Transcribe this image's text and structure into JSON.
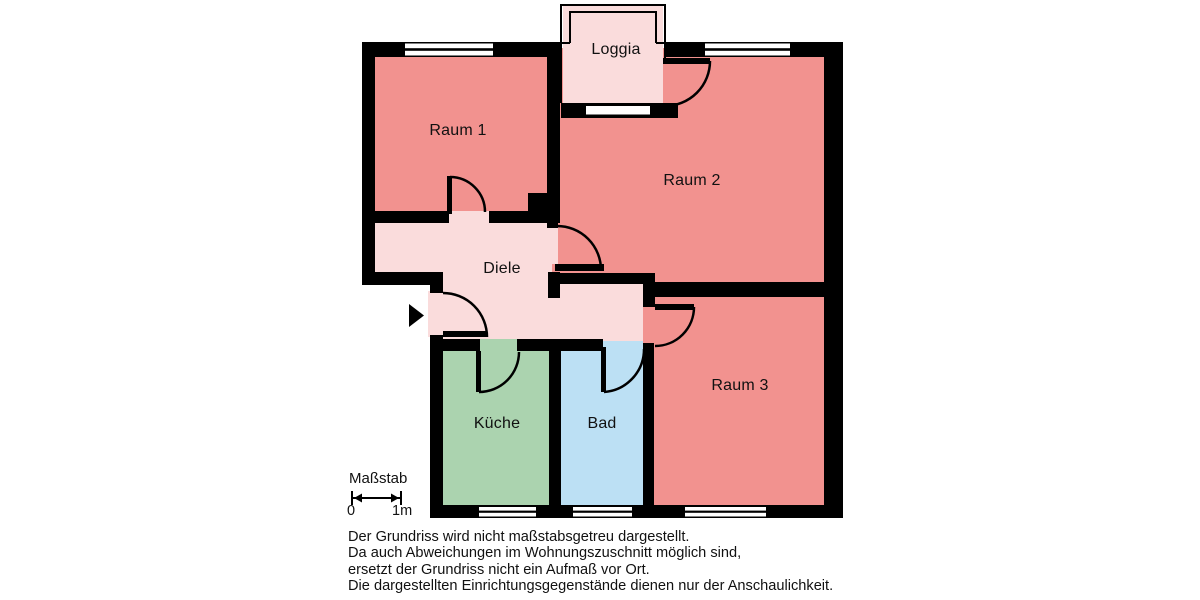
{
  "colors": {
    "room_salmon": "#f2928f",
    "hall_pink": "#fadcdc",
    "kitchen_green": "#abd3af",
    "bath_blue": "#bce0f4",
    "window_white": "#ffffff",
    "wall_black": "#000000"
  },
  "rooms": {
    "loggia": {
      "label": "Loggia"
    },
    "raum1": {
      "label": "Raum 1"
    },
    "raum2": {
      "label": "Raum 2"
    },
    "raum3": {
      "label": "Raum 3"
    },
    "diele": {
      "label": "Diele"
    },
    "kueche": {
      "label": "Küche"
    },
    "bad": {
      "label": "Bad"
    }
  },
  "scale": {
    "label": "Maßstab",
    "start_label": "0",
    "end_label": "1m"
  },
  "disclaimer": {
    "lines": [
      "Der Grundriss wird nicht maßstabsgetreu dargestellt.",
      "Da auch Abweichungen im Wohnungszuschnitt möglich sind,",
      "ersetzt der Grundriss nicht ein Aufmaß vor Ort.",
      "Die dargestellten Einrichtungsgegenstände dienen nur der Anschaulichkeit."
    ]
  }
}
